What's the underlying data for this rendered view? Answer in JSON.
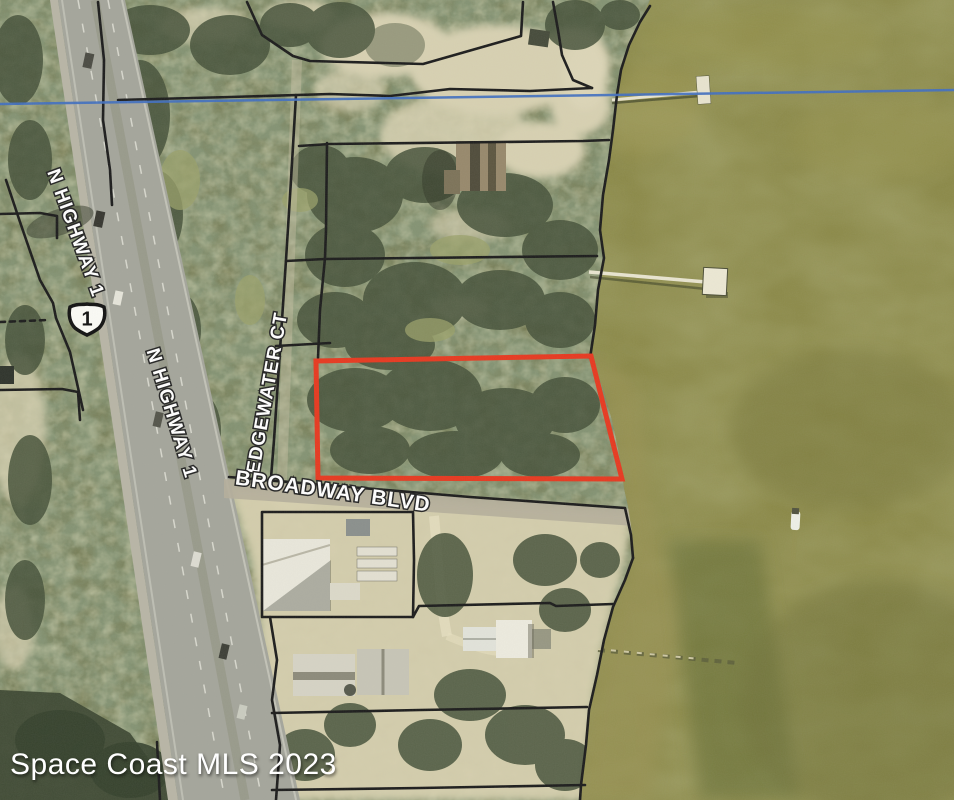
{
  "map": {
    "watermark": "Space Coast MLS 2023",
    "labels": {
      "highway_upper": "N HIGHWAY 1",
      "highway_lower": "N HIGHWAY 1",
      "edgewater": "EDGEWATER CT",
      "broadway": "BROADWAY BLVD",
      "route_shield": "1"
    },
    "colors": {
      "parcel_highlight": "#e7381f",
      "boundary_line": "#1b1b1b",
      "hydro_line": "#416fc0",
      "water": "#8b8948",
      "road": "#a4a59b",
      "sand": "#d8d1b2",
      "label_text": "#ffffff"
    }
  }
}
